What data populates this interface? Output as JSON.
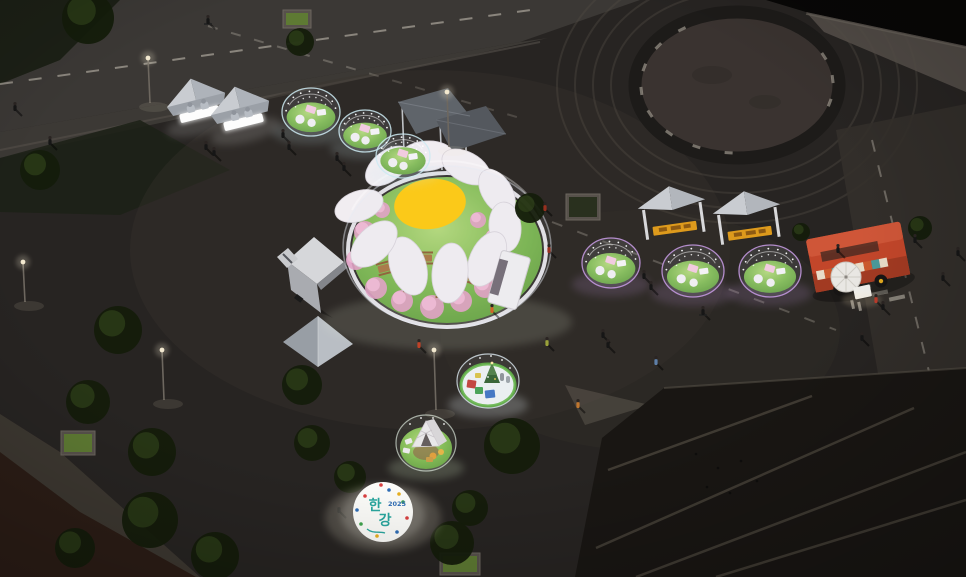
{
  "logo": {
    "char1": "한",
    "char2": "강",
    "year": "2025"
  },
  "colors": {
    "bg": "#272422",
    "road": "#3b3835",
    "road_line": "#d8d2c4",
    "curb": "#55504a",
    "ring_dark": "#1d1b19",
    "ring_inner": "#3b3531",
    "concrete": "#56504a",
    "water": "#080706",
    "terrace": "#191613",
    "terrace_line": "#6e6659",
    "brick": "#2c1d16",
    "grass_bright": "#8cc35c",
    "grass_dark": "#5f9c3c",
    "daisy_yellow": "#ffc808",
    "petal_white": "#f1edf1",
    "blossom_pink": "#efb7d2",
    "blossom_deep": "#e39fc4",
    "table_wood": "#a8743f",
    "glow_cool": "#cdeaf2",
    "glow_purple": "#c99ce6",
    "pouf_white": "#f2f0f2",
    "table_pink": "#f4c9de",
    "tent_light": "#c9ccd1",
    "tent_dark": "#aeb3ba",
    "tent_skirt": "#9ba0a7",
    "sign_yellow": "#dd9a1c",
    "truck_white": "#d6d7da",
    "foodtruck_red": "#c2462a",
    "foodtruck_shade": "#a23a22",
    "umbrella": "#e9e7e3",
    "xmas_floor": "#edf0f1",
    "xmas_ring": "#5cb13e",
    "gift_red": "#c23a32",
    "gift_green": "#3f9e4c",
    "gift_blue": "#3a6fc0",
    "cabin_white": "#eae8ea",
    "deck_wood": "#c29258",
    "seat_orange": "#e09a33",
    "logo_teal": "#2aa79f",
    "logo_blue": "#2f6db5",
    "tree_dark": "#141c0b",
    "tree_light": "#33471d",
    "person": "#161616",
    "lamp_warm": "#f2e8cf"
  },
  "bubble_domes": [
    {
      "cx": 311,
      "cy": 112,
      "rx": 29,
      "ry": 24,
      "glow": "cool"
    },
    {
      "cx": 365,
      "cy": 131,
      "rx": 26,
      "ry": 21,
      "glow": "cool"
    },
    {
      "cx": 403,
      "cy": 156,
      "rx": 27,
      "ry": 22,
      "glow": "cool"
    },
    {
      "cx": 611,
      "cy": 263,
      "rx": 29,
      "ry": 25,
      "glow": "purple"
    },
    {
      "cx": 693,
      "cy": 271,
      "rx": 31,
      "ry": 26,
      "glow": "purple"
    },
    {
      "cx": 770,
      "cy": 271,
      "rx": 31,
      "ry": 26,
      "glow": "purple"
    }
  ],
  "daisy": {
    "petals": [
      {
        "x": 388,
        "y": 166,
        "rot": -38,
        "rx": 26,
        "ry": 15
      },
      {
        "x": 426,
        "y": 156,
        "rot": -5,
        "rx": 27,
        "ry": 15
      },
      {
        "x": 466,
        "y": 167,
        "rot": 28,
        "rx": 26,
        "ry": 15
      },
      {
        "x": 497,
        "y": 192,
        "rot": 58,
        "rx": 25,
        "ry": 15
      },
      {
        "x": 505,
        "y": 227,
        "rot": 85,
        "rx": 25,
        "ry": 16
      },
      {
        "x": 487,
        "y": 259,
        "rot": 115,
        "rx": 29,
        "ry": 17
      },
      {
        "x": 450,
        "y": 273,
        "rot": 95,
        "rx": 30,
        "ry": 18
      },
      {
        "x": 408,
        "y": 266,
        "rot": 72,
        "rx": 30,
        "ry": 18
      },
      {
        "x": 374,
        "y": 244,
        "rot": 135,
        "rx": 28,
        "ry": 17
      },
      {
        "x": 359,
        "y": 206,
        "rot": 160,
        "rx": 25,
        "ry": 15
      }
    ],
    "blossoms": [
      {
        "x": 365,
        "y": 232,
        "r": 11
      },
      {
        "x": 356,
        "y": 260,
        "r": 10
      },
      {
        "x": 376,
        "y": 288,
        "r": 11
      },
      {
        "x": 402,
        "y": 301,
        "r": 11
      },
      {
        "x": 432,
        "y": 307,
        "r": 12
      },
      {
        "x": 461,
        "y": 301,
        "r": 11
      },
      {
        "x": 485,
        "y": 287,
        "r": 11
      },
      {
        "x": 500,
        "y": 263,
        "r": 10
      },
      {
        "x": 494,
        "y": 238,
        "r": 9
      },
      {
        "x": 382,
        "y": 210,
        "r": 8
      },
      {
        "x": 478,
        "y": 220,
        "r": 8
      }
    ],
    "tables": [
      {
        "x": 385,
        "y": 268,
        "rot": -15
      },
      {
        "x": 412,
        "y": 287,
        "rot": 10
      },
      {
        "x": 443,
        "y": 291,
        "rot": -5
      },
      {
        "x": 468,
        "y": 276,
        "rot": 20
      },
      {
        "x": 425,
        "y": 258,
        "rot": 0
      }
    ]
  },
  "trees": [
    {
      "x": 88,
      "y": 18,
      "r": 26
    },
    {
      "x": 40,
      "y": 170,
      "r": 20
    },
    {
      "x": 300,
      "y": 42,
      "r": 14
    },
    {
      "x": 118,
      "y": 330,
      "r": 24
    },
    {
      "x": 88,
      "y": 402,
      "r": 22
    },
    {
      "x": 152,
      "y": 452,
      "r": 24
    },
    {
      "x": 302,
      "y": 385,
      "r": 20
    },
    {
      "x": 312,
      "y": 443,
      "r": 18
    },
    {
      "x": 350,
      "y": 477,
      "r": 16
    },
    {
      "x": 452,
      "y": 543,
      "r": 22
    },
    {
      "x": 512,
      "y": 446,
      "r": 28
    },
    {
      "x": 470,
      "y": 508,
      "r": 18
    },
    {
      "x": 530,
      "y": 208,
      "r": 15
    },
    {
      "x": 920,
      "y": 228,
      "r": 12
    },
    {
      "x": 801,
      "y": 232,
      "r": 9
    },
    {
      "x": 150,
      "y": 520,
      "r": 28
    },
    {
      "x": 215,
      "y": 556,
      "r": 24
    },
    {
      "x": 75,
      "y": 548,
      "r": 20
    }
  ],
  "planters": [
    {
      "x": 61,
      "y": 431,
      "w": 34,
      "h": 24,
      "lit": true
    },
    {
      "x": 283,
      "y": 10,
      "w": 28,
      "h": 18,
      "lit": true
    },
    {
      "x": 566,
      "y": 194,
      "w": 34,
      "h": 26,
      "lit": false
    },
    {
      "x": 440,
      "y": 553,
      "w": 40,
      "h": 22,
      "lit": true
    }
  ],
  "lamps": [
    {
      "x": 148,
      "y": 58,
      "h": 45
    },
    {
      "x": 23,
      "y": 262,
      "h": 40
    },
    {
      "x": 447,
      "y": 92,
      "h": 55
    },
    {
      "x": 434,
      "y": 350,
      "h": 60
    },
    {
      "x": 162,
      "y": 350,
      "h": 50
    }
  ],
  "people": [
    {
      "x": 15,
      "y": 107
    },
    {
      "x": 50,
      "y": 141
    },
    {
      "x": 208,
      "y": 20,
      "bike": true
    },
    {
      "x": 283,
      "y": 134
    },
    {
      "x": 289,
      "y": 146
    },
    {
      "x": 337,
      "y": 157
    },
    {
      "x": 344,
      "y": 167
    },
    {
      "x": 206,
      "y": 146
    },
    {
      "x": 214,
      "y": 152
    },
    {
      "x": 419,
      "y": 344,
      "c": "#bf4227"
    },
    {
      "x": 545,
      "y": 207,
      "c": "#97301f"
    },
    {
      "x": 549,
      "y": 249,
      "c": "#97301f"
    },
    {
      "x": 492,
      "y": 309,
      "c": "#d06428"
    },
    {
      "x": 644,
      "y": 275
    },
    {
      "x": 651,
      "y": 286
    },
    {
      "x": 703,
      "y": 311,
      "bike": true
    },
    {
      "x": 915,
      "y": 239
    },
    {
      "x": 943,
      "y": 277
    },
    {
      "x": 876,
      "y": 299,
      "c": "#bb3b2b"
    },
    {
      "x": 883,
      "y": 306
    },
    {
      "x": 862,
      "y": 337
    },
    {
      "x": 547,
      "y": 342,
      "c": "#9aa23a"
    },
    {
      "x": 603,
      "y": 334
    },
    {
      "x": 608,
      "y": 344
    },
    {
      "x": 656,
      "y": 361,
      "c": "#5e7fa8"
    },
    {
      "x": 578,
      "y": 404,
      "c": "#c0762e"
    },
    {
      "x": 339,
      "y": 509
    },
    {
      "x": 838,
      "y": 249
    },
    {
      "x": 958,
      "y": 252
    }
  ],
  "birds": [
    {
      "x": 696,
      "y": 454
    },
    {
      "x": 718,
      "y": 468
    },
    {
      "x": 741,
      "y": 461
    },
    {
      "x": 757,
      "y": 481
    },
    {
      "x": 707,
      "y": 487
    },
    {
      "x": 730,
      "y": 493
    }
  ],
  "ring_ticks": [
    95,
    115,
    135,
    155,
    175,
    195,
    215,
    235,
    -5,
    -25,
    15
  ],
  "confetti": [
    {
      "x": -18,
      "y": -16,
      "c": "#d94040"
    },
    {
      "x": 6,
      "y": -22,
      "c": "#2f6db5"
    },
    {
      "x": 20,
      "y": -10,
      "c": "#3fa34d"
    },
    {
      "x": 24,
      "y": 6,
      "c": "#d94040"
    },
    {
      "x": 14,
      "y": 20,
      "c": "#2f6db5"
    },
    {
      "x": -6,
      "y": 24,
      "c": "#e8b020"
    },
    {
      "x": -22,
      "y": 12,
      "c": "#3fa34d"
    },
    {
      "x": -26,
      "y": -2,
      "c": "#2f6db5"
    },
    {
      "x": -2,
      "y": -27,
      "c": "#d94040"
    },
    {
      "x": 16,
      "y": -18,
      "c": "#e8b020"
    }
  ]
}
